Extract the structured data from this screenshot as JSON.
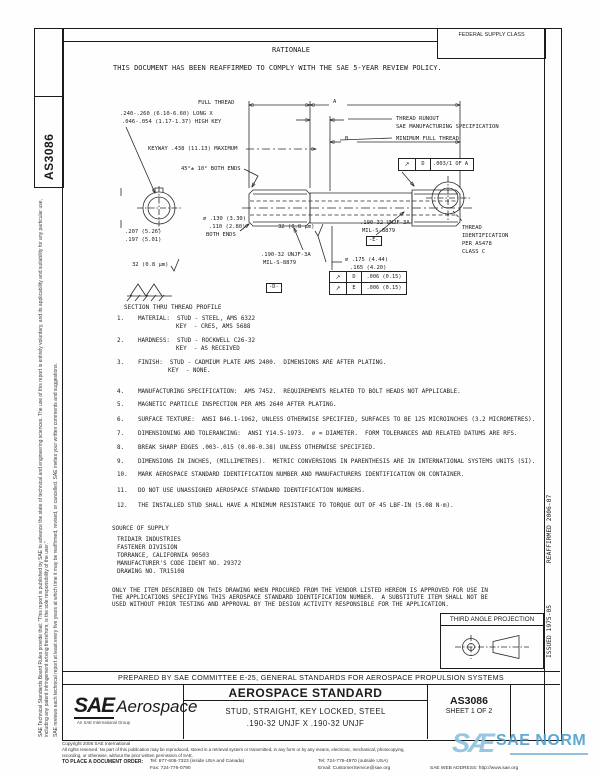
{
  "colors": {
    "ink": "#1b1b1b",
    "watermark_blue": "#4f9fce",
    "watermark_light": "#8fc0de"
  },
  "side_box_label": "AS3086",
  "left_margin": {
    "para1": "SAE Technical Standards Board Rules provide that: \"This report is published by SAE to advance the state of technical and engineering sciences. The use of this report is entirely voluntary, and its applicability and suitability for any particular use, including any patent infringement arising therefrom, is the sole responsibility of the user.\"",
    "para2": "SAE reviews each technical report at least every five years at which time it may be reaffirmed, revised, or cancelled. SAE invites your written comments and suggestions."
  },
  "right_margin": {
    "reaffirmed": "REAFFIRMED 2006-07",
    "issued": "ISSUED 1975-05"
  },
  "header": {
    "federal_supply_class": "FEDERAL SUPPLY CLASS",
    "rationale": "RATIONALE",
    "notice": "THIS DOCUMENT HAS BEEN REAFFIRMED TO COMPLY WITH THE SAE 5-YEAR REVIEW POLICY."
  },
  "drawing": {
    "full_thread": "FULL THREAD",
    "dim_a": "A",
    "dim_b": "B",
    "key_l1": ".240-.260 (6.10-6.60) LONG X",
    "key_l2": ".046-.054 (1.17-1.37) HIGH KEY",
    "keyway": "KEYWAY .438 (11.13) MAXIMUM",
    "chamfer": "45°± 10° BOTH ENDS",
    "runout_l1": "THREAD RUNOUT",
    "runout_l2": "SAE MANUFACTURING SPECIFICATION",
    "min_full_thread": "MINIMUM FULL THREAD",
    "fcf_top_sym": "↗",
    "fcf_top_datum": "D",
    "fcf_top_tol": ".003/1 OF A",
    "thread_id_l1": "THREAD",
    "thread_id_l2": "IDENTIFICATION",
    "thread_id_l3": "PER AS478",
    "thread_id_l4": "CLASS C",
    "dia_ends_l1": "⌀ .130 (3.30)",
    "dia_ends_l2": ".110 (2.80)",
    "dia_ends_l3": "BOTH ENDS",
    "across_l1": ".207 (5.26)",
    "across_l2": ".197 (5.01)",
    "finish_left": "32 (0.8 μm)",
    "finish_mid": "32 (0.8 μm)",
    "thread_d_l1": ".190-32 UNJF-3A",
    "thread_d_l2": "MIL-S-8879",
    "datum_d": "-D-",
    "thread_e_l1": ".190-32 UNJF-3A",
    "thread_e_l2": "MIL-S-8879",
    "datum_e": "-E-",
    "dia_mid_l1": "⌀ .175 (4.44)",
    "dia_mid_l2": ".165 (4.20)",
    "fcf_d_sym": "↗",
    "fcf_d_datum": "D",
    "fcf_d_tol": ".006 (0.15)",
    "fcf_e_sym": "↗",
    "fcf_e_datum": "E",
    "fcf_e_tol": ".006 (0.15)",
    "section_label": "SECTION THRU THREAD PROFILE"
  },
  "notes": [
    {
      "num": "1.",
      "text": "MATERIAL:  STUD - STEEL, AMS 6322",
      "cont": "KEY  - CRES, AMS 5688"
    },
    {
      "num": "2.",
      "text": "HARDNESS:  STUD - ROCKWELL C26-32",
      "cont": "KEY  - AS RECEIVED"
    },
    {
      "num": "3.",
      "text": "FINISH:  STUD - CADMIUM PLATE AMS 2400.  DIMENSIONS ARE AFTER PLATING.",
      "cont": "KEY  - NONE."
    },
    {
      "num": "4.",
      "text": "MANUFACTURING SPECIFICATION:  AMS 7452.  REQUIREMENTS RELATED TO BOLT HEADS NOT APPLICABLE."
    },
    {
      "num": "5.",
      "text": "MAGNETIC PARTICLE INSPECTION PER AMS 2640 AFTER PLATING."
    },
    {
      "num": "6.",
      "text": "SURFACE TEXTURE:  ANSI B46.1-1962, UNLESS OTHERWISE SPECIFIED, SURFACES TO BE 125 MICROINCHES (3.2 MICROMETRES)."
    },
    {
      "num": "7.",
      "text": "DIMENSIONING AND TOLERANCING:  ANSI Y14.5-1973.  ⌀ = DIAMETER.  FORM TOLERANCES AND RELATED DATUMS ARE RFS."
    },
    {
      "num": "8.",
      "text": "BREAK SHARP EDGES .003-.015 (0.08-0.38) UNLESS OTHERWISE SPECIFIED."
    },
    {
      "num": "9.",
      "text": "DIMENSIONS IN INCHES, (MILLIMETRES).  METRIC CONVERSIONS IN PARENTHESIS ARE IN INTERNATIONAL SYSTEMS UNITS (SI)."
    },
    {
      "num": "10.",
      "text": "MARK AEROSPACE STANDARD IDENTIFICATION NUMBER AND MANUFACTURERS IDENTIFICATION ON CONTAINER."
    },
    {
      "num": "11.",
      "text": "DO NOT USE UNASSIGNED AEROSPACE STANDARD IDENTIFICATION NUMBERS."
    },
    {
      "num": "12.",
      "text": "THE INSTALLED STUD SHALL HAVE A MINIMUM RESISTANCE TO TORQUE OUT OF 45 LBF-IN (5.08 N·m)."
    }
  ],
  "supply": {
    "title": "SOURCE OF SUPPLY",
    "l1": "TRIDAIR INDUSTRIES",
    "l2": "FASTENER DIVISION",
    "l3": "TORRANCE, CALIFORNIA 90503",
    "l4": "MANUFACTURER'S CODE IDENT NO. 29372",
    "l5": "DRAWING NO. TR15108"
  },
  "vendor_notice": {
    "l1": "ONLY THE ITEM DESCRIBED ON THIS DRAWING WHEN PROCURED FROM THE VENDOR LISTED HEREON IS APPROVED FOR USE IN",
    "l2": "THE APPLICATIONS SPECIFYING THIS AEROSPACE STANDARD IDENTIFICATION NUMBER.  A SUBSTITUTE ITEM SHALL NOT BE",
    "l3": "USED WITHOUT PRIOR TESTING AND APPROVAL BY THE DESIGN ACTIVITY RESPONSIBLE FOR THE APPLICATION."
  },
  "projection": {
    "title": "THIRD ANGLE PROJECTION"
  },
  "prepared_by": "PREPARED BY SAE COMMITTEE E-25, GENERAL STANDARDS FOR AEROSPACE PROPULSION SYSTEMS",
  "title_block": {
    "brand_sae": "SAE",
    "brand_aerospace": "Aerospace",
    "brand_tagline": "An SAE International Group",
    "doc_type": "AEROSPACE STANDARD",
    "title_l1": "STUD, STRAIGHT, KEY LOCKED, STEEL",
    "title_l2": ".190-32 UNJF X .190-32 UNJF",
    "number": "AS3086",
    "sheet": "SHEET 1 OF 2"
  },
  "footer": {
    "copyright": "Copyright 2006 SAE International",
    "rights_l1": "All rights reserved. No part of this publication may be reproduced, stored in a retrieval system or transmitted, in any form or by any means, electronic, mechanical, photocopying,",
    "rights_l2": "recording, or otherwise, without the prior written permission of SAE.",
    "order": "TO PLACE A DOCUMENT ORDER:",
    "tel_us": "Tel: 877-606-7323 (inside USA and Canada)",
    "tel_intl": "Tel: 724-776-4970 (outside USA)",
    "fax": "Fax: 724-776-0790",
    "email": "Email: CustomerService@sae.org",
    "web": "SAE WEB ADDRESS: http://www.sae.org"
  },
  "watermark": {
    "logo": "SÆ",
    "text": "SAE NORM"
  }
}
